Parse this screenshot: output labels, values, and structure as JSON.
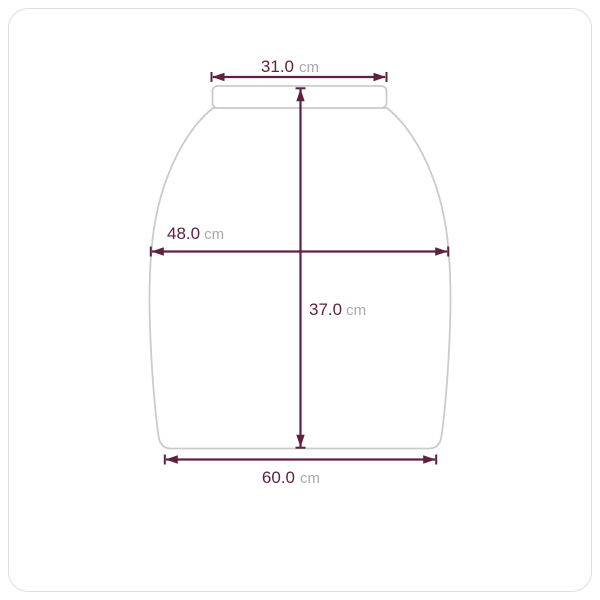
{
  "colors": {
    "accent": "#5E2144",
    "outline": "#CBCBCB",
    "unit_text": "#A9A9A9",
    "card_border": "#DDDDDD",
    "background": "#FFFFFF"
  },
  "diagram": {
    "measurements": {
      "top_width": {
        "value": "31.0",
        "unit": "cm"
      },
      "mid_width": {
        "value": "48.0",
        "unit": "cm"
      },
      "length": {
        "value": "37.0",
        "unit": "cm"
      },
      "bottom_width": {
        "value": "60.0",
        "unit": "cm"
      }
    }
  }
}
